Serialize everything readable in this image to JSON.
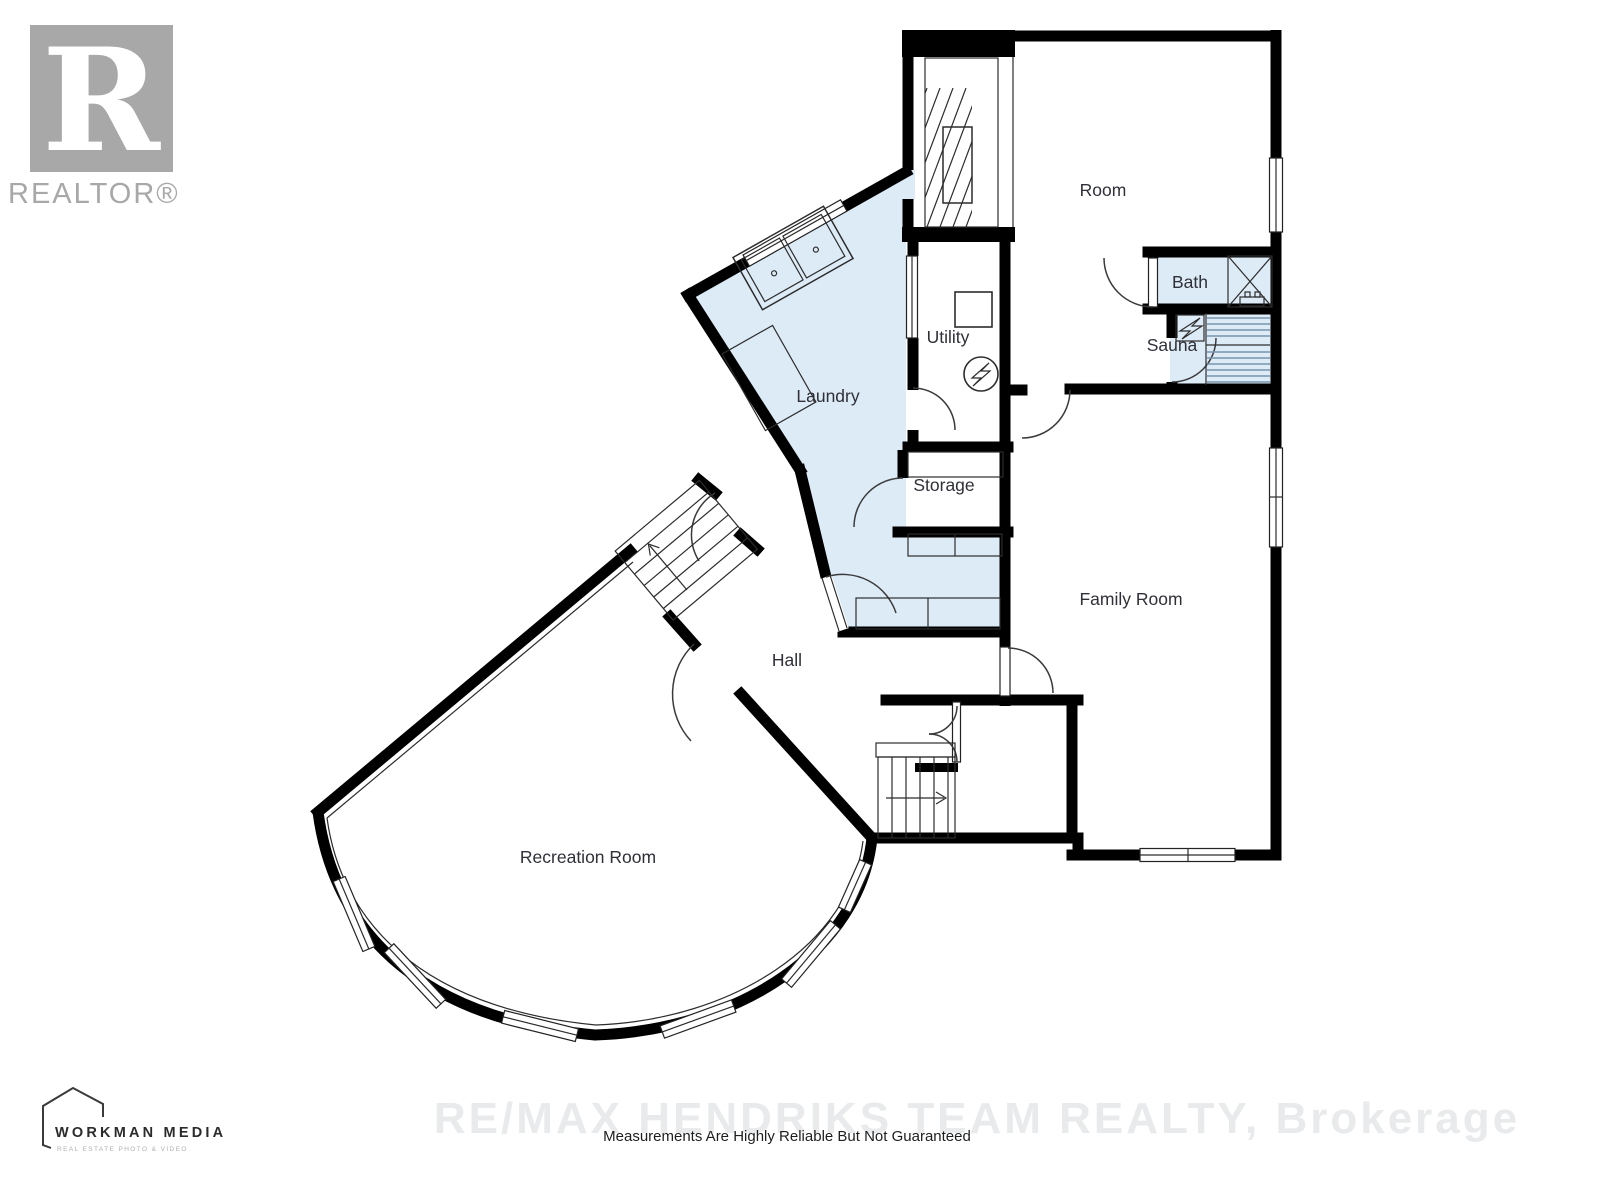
{
  "branding": {
    "realtor_logo": {
      "letter": "R",
      "wordmark": "REALTOR®"
    },
    "workman_logo": {
      "name": "WORKMAN MEDIA",
      "tagline": "REAL ESTATE PHOTO & VIDEO"
    }
  },
  "watermark": {
    "brokerage": "RE/MAX HENDRIKS TEAM REALTY, Brokerage",
    "disclaimer": "Measurements Are Highly Reliable But Not Guaranteed"
  },
  "rooms": {
    "room": "Room",
    "bath": "Bath",
    "sauna": "Sauna",
    "utility": "Utility",
    "laundry": "Laundry",
    "storage": "Storage",
    "family_room": "Family Room",
    "hall": "Hall",
    "recreation_room": "Recreation Room"
  },
  "icons": {
    "electrical_panel": "circle-lightning",
    "sauna_heater": "box-lightning",
    "shower": "box-x-cross",
    "stairs_up": "arrow-up",
    "stairs_down": "arrow-right",
    "double_sink": "two-basins",
    "house_outline": "pentagon-outline"
  },
  "colors": {
    "wall": "#000000",
    "highlight_fill": "#ddebf7",
    "label": "#2f3038",
    "watermark_gray": "#e8eaeb",
    "logo_gray": "#a8a8a8",
    "bench_line": "#7795ad"
  }
}
